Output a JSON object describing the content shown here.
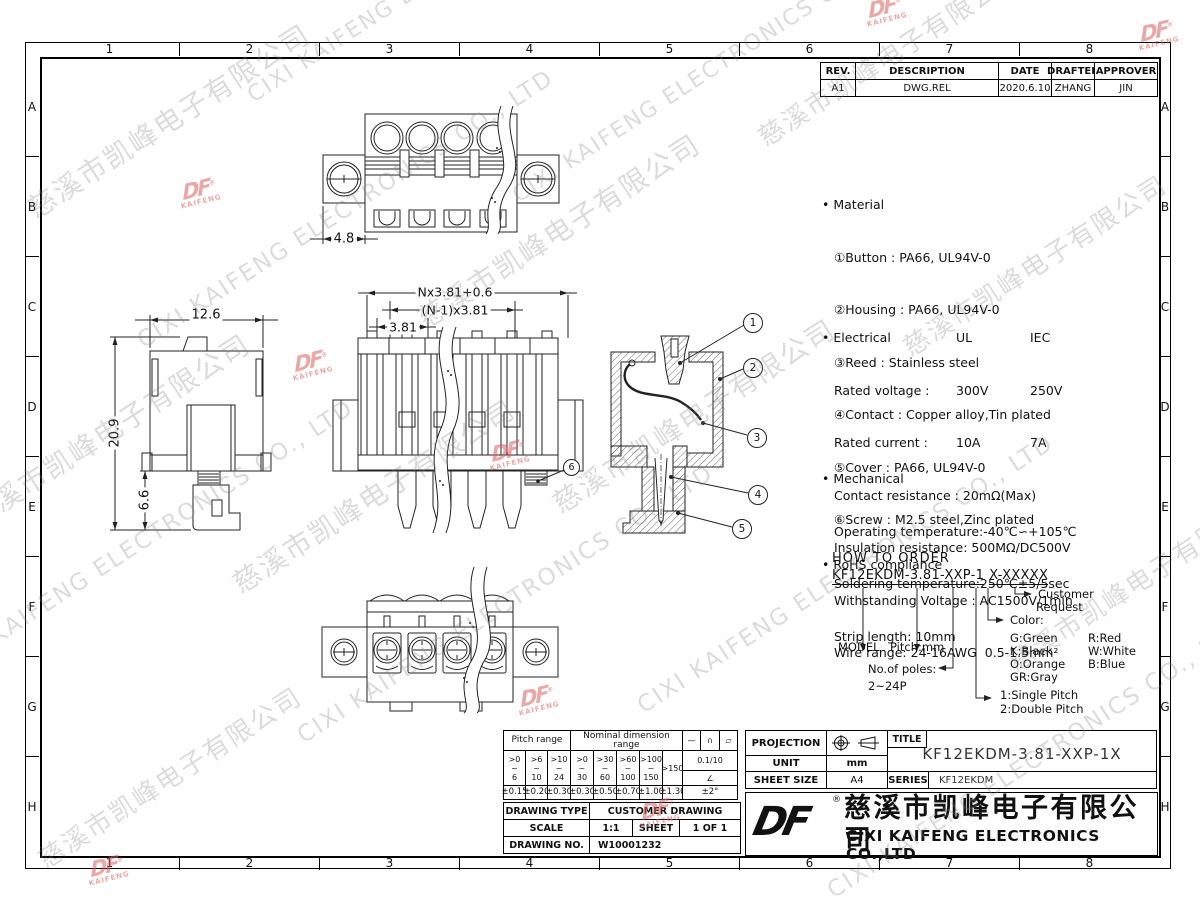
{
  "sheet": {
    "border_cols": [
      "1",
      "2",
      "3",
      "4",
      "5",
      "6",
      "7",
      "8"
    ],
    "border_rows": [
      "A",
      "B",
      "C",
      "D",
      "E",
      "F",
      "G",
      "H"
    ]
  },
  "watermark": {
    "company_cn": "慈溪市凯峰电子有限公司",
    "company_en": "CIXI KAIFENG ELECTRONICS CO., LTD",
    "logo_text": "DF",
    "logo_sub": "KAIFENG",
    "reg": "®"
  },
  "revision_table": {
    "headers": [
      "REV.",
      "DESCRIPTION",
      "DATE",
      "DRAFTER",
      "APPROVER"
    ],
    "row": [
      "A1",
      "DWG.REL",
      "2020.6.10",
      "ZHANG",
      "JIN"
    ]
  },
  "notes": {
    "material": {
      "title": "Material",
      "items": [
        "①Button : PA66, UL94V-0",
        "②Housing : PA66, UL94V-0",
        "③Reed : Stainless steel",
        "④Contact : Copper alloy,Tin plated",
        "⑤Cover : PA66, UL94V-0",
        "⑥Screw : M2.5 steel,Zinc plated"
      ]
    },
    "electrical": {
      "title": "Electrical",
      "col1": "UL",
      "col2": "IEC",
      "rows": [
        [
          "Rated voltage :",
          "300V",
          "250V"
        ],
        [
          "Rated current :",
          "10A",
          "7A"
        ]
      ],
      "lines": [
        "Contact resistance : 20mΩ(Max)",
        "Insulation resistance: 500MΩ/DC500V",
        "Withstanding Voltage : AC1500V/1min",
        "Wire range: 24-16AWG  0.5-1.5mm²"
      ]
    },
    "mechanical": {
      "title": "Mechanical",
      "lines": [
        "Operating temperature:-40℃∽+105℃",
        "Soldering temperature:250℃±5/5sec",
        "Strip length: 10mm"
      ]
    },
    "rohs": {
      "title": "RoHS compliance"
    }
  },
  "how_to_order": {
    "title": "HOW TO ORDER",
    "code_group1": "KF12EKDM-3.81-XXP-1",
    "code_group2": "X-XXXXX",
    "model_label": "MODEL",
    "pitch_label": "Pitch:mm",
    "poles_label": "No.of poles:",
    "poles_value": "2~24P",
    "pitch_type_1": "1:Single Pitch",
    "pitch_type_2": "2:Double Pitch",
    "color_label": "Color:",
    "colors": [
      [
        "G:Green",
        "R:Red"
      ],
      [
        "K:Black",
        "W:White"
      ],
      [
        "O:Orange",
        "B:Blue"
      ],
      [
        "GR:Gray",
        ""
      ]
    ],
    "customer_1": "Customer",
    "customer_2": "Request"
  },
  "dimensions": {
    "flange_width": "4.8",
    "body_width": "12.6",
    "height": "20.9",
    "pin_length": "6.6",
    "total_pitch": "Nx3.81+0.6",
    "inner_pitch": "(N-1)x3.81",
    "pitch": "3.81"
  },
  "balloons": [
    "1",
    "2",
    "3",
    "4",
    "5",
    "6"
  ],
  "tolerance_table": {
    "pitch_header": "Pitch range",
    "nominal_header": "Nominal dimension range",
    "symbols": [
      "—",
      "∩",
      "▱"
    ],
    "pitch_ranges": [
      [
        ">0",
        "~",
        "6"
      ],
      [
        ">6",
        "~",
        "10"
      ],
      [
        ">10",
        "~",
        "24"
      ]
    ],
    "nominal_ranges": [
      [
        ">0",
        "~",
        "30"
      ],
      [
        ">30",
        "~",
        "60"
      ],
      [
        ">60",
        "~",
        "100"
      ],
      [
        ">100",
        "~",
        "150"
      ]
    ],
    "nominal_last": ">150",
    "chamfer": "0.1/10",
    "angle_symbol": "∠",
    "angle_tol": "±2°",
    "pitch_tols": [
      "±0.15",
      "±0.20",
      "±0.30"
    ],
    "nominal_tols": [
      "±0.30",
      "±0.50",
      "±0.70",
      "±1.00",
      "±1.30"
    ]
  },
  "info_table": {
    "drawing_type_label": "DRAWING TYPE",
    "drawing_type": "CUSTOMER DRAWING",
    "scale_label": "SCALE",
    "scale": "1:1",
    "sheet_label": "SHEET",
    "sheet": "1 OF 1",
    "drawing_no_label": "DRAWING NO.",
    "drawing_no": "W10001232"
  },
  "title_block": {
    "projection_label": "PROJECTION",
    "unit_label": "UNIT",
    "unit": "mm",
    "sheet_size_label": "SHEET SIZE",
    "sheet_size": "A4",
    "title_label": "TITLE",
    "title": "KF12EKDM-3.81-XXP-1X",
    "series_label": "SERIES",
    "series": "KF12EKDM",
    "logo_text": "DF",
    "reg": "®",
    "company_cn": "慈溪市凯峰电子有限公司",
    "company_en": "CIXI KAIFENG ELECTRONICS CO.,LTD"
  }
}
